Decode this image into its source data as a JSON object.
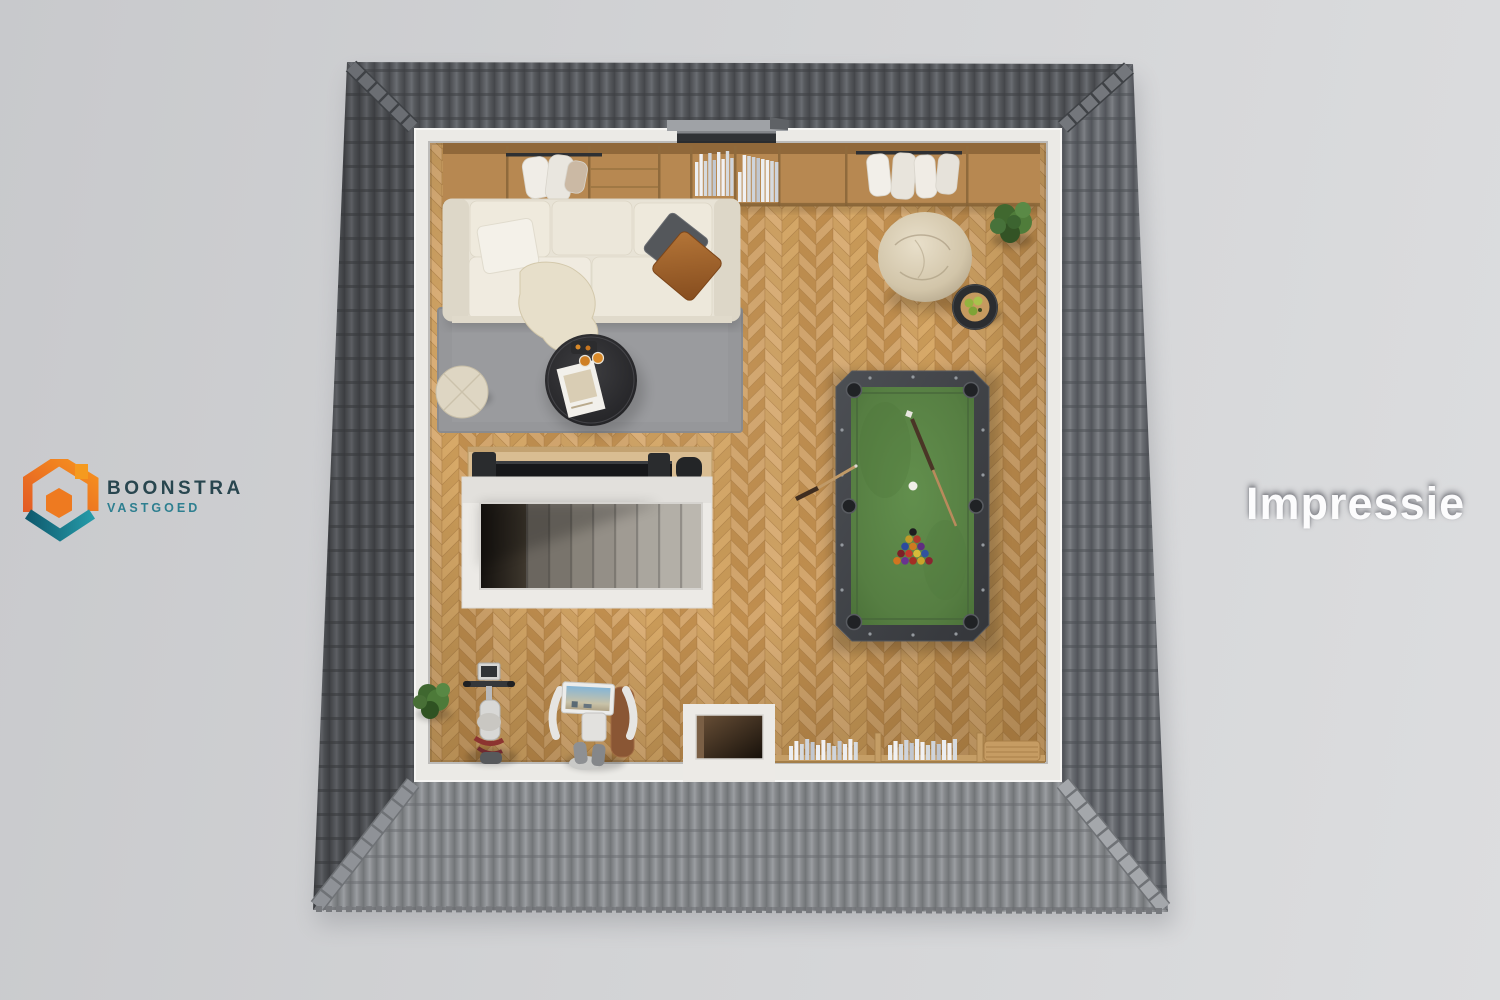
{
  "brand": {
    "name": "BOONSTRA",
    "tagline": "VASTGOED"
  },
  "watermark": "Impressie",
  "scene": {
    "type": "3d-floorplan-top-view-impression",
    "items": [
      "wardrobe with hanging clothes",
      "shelf cubbies with books",
      "cream sofa with pillows",
      "throw blanket",
      "grey area rug",
      "round coffee table with magazine and drinks",
      "round pouf",
      "tv console",
      "staircase with white enclosure",
      "pool table with racked balls and cues",
      "bean bag",
      "black side table with fruit bowl",
      "potted plants",
      "low bookshelf with books",
      "roof window slot",
      "floor void opening",
      "exercise bike",
      "trainer with screen",
      "grey tiled hip roof"
    ],
    "palette": {
      "background_left": "#c8c9cc",
      "background_right": "#dcdddf",
      "roof_top": "#56585c",
      "roof_right": "#64676c",
      "roof_bottom": "#8a8c8f",
      "wall": "#ebeae6",
      "floor_oak": "#cd9f68",
      "rug": "#96979a",
      "sofa": "#e8e3d6",
      "felt_green": "#578043",
      "wood_cabinet": "#b78851",
      "logo_orange": "#f08122",
      "logo_teal": "#1b7a8c"
    },
    "textures": {
      "oak_tones": [
        "#d4a76e",
        "#c99a58",
        "#dcb078",
        "#c08e4e",
        "#d7a968",
        "#cfa263"
      ],
      "book_tones": [
        "#eceef1",
        "#d6dade",
        "#c1c7d0",
        "#f1f1f3",
        "#cfd4db"
      ],
      "stair_steps": [
        "#6b665f",
        "#79746c",
        "#88837a",
        "#948f87",
        "#a09b93",
        "#aaa69e",
        "#b3afa7",
        "#bbb7af"
      ],
      "pool_balls": [
        "#1d1d1f",
        "#c29a28",
        "#ae3a2c",
        "#2c4a9e",
        "#cf7a1f",
        "#5f2e80",
        "#7c2026",
        "#c2392b",
        "#d8ba3a",
        "#31529f",
        "#d07520",
        "#6a3390",
        "#a32e24",
        "#caa32a",
        "#8a2430"
      ]
    }
  }
}
